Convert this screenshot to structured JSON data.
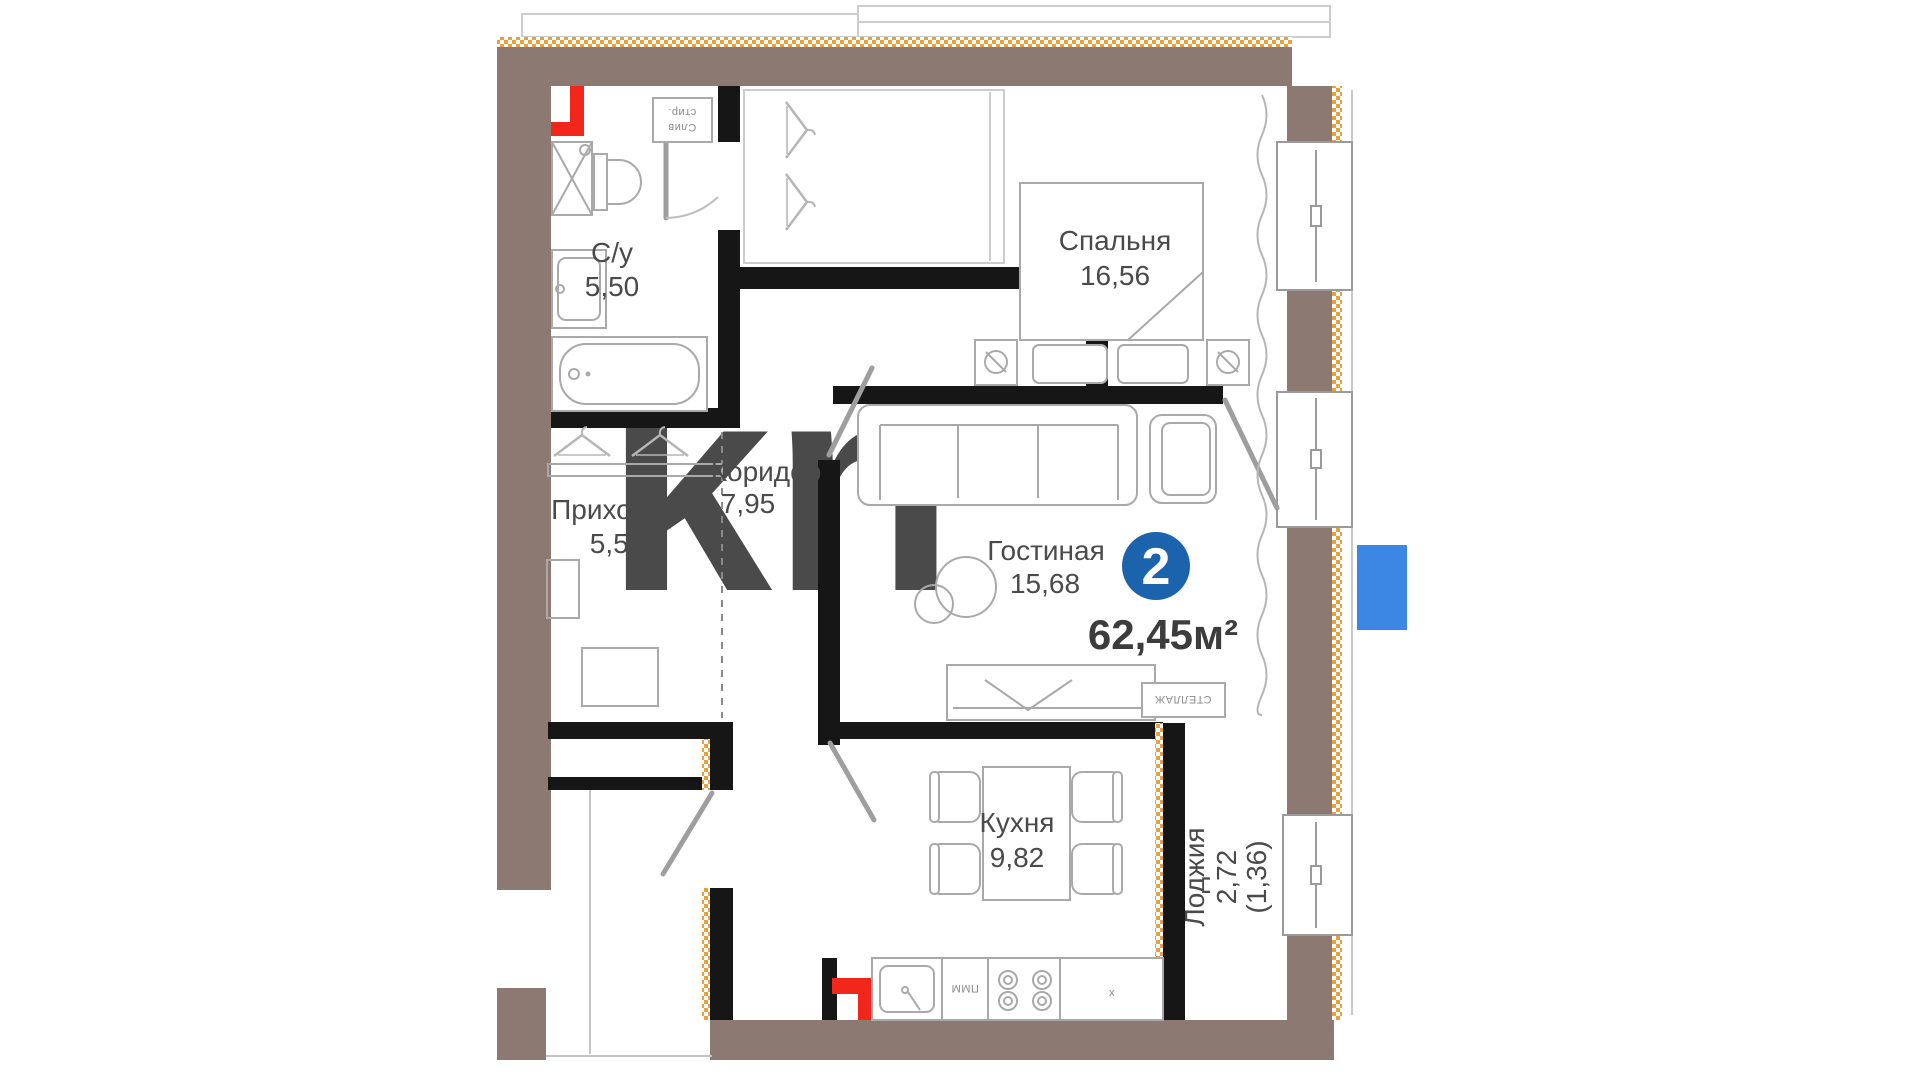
{
  "plan": {
    "badge_rooms": "2",
    "total_area": "62,45м²",
    "watermark": "kn"
  },
  "rooms": {
    "bathroom": {
      "name": "С/у",
      "area": "5,50"
    },
    "bedroom": {
      "name": "Спальня",
      "area": "16,56"
    },
    "corridor": {
      "name": "Коридор",
      "area": "7,95"
    },
    "hallway": {
      "name": "Прихожая",
      "area": "5,58"
    },
    "living": {
      "name": "Гостиная",
      "area": "15,68"
    },
    "kitchen": {
      "name": "Кухня",
      "area": "9,82"
    },
    "loggia": {
      "name": "Лоджия",
      "area": "2,72",
      "coef": "(1,36)"
    }
  },
  "annotations": {
    "drain_line1": "Слив",
    "drain_line2": "стир.",
    "shelf": "СТЕЛЛАЖ",
    "dishwasher": "ПММ",
    "counter_mark": "x"
  },
  "colors": {
    "wall_brown": "#8C7A72",
    "insulation_orange": "#E8A13C",
    "wall_black": "#161616",
    "badge_blue": "#1B63AC",
    "marker_blue": "#3B87E3",
    "pipe_red": "#F2261B",
    "line_gray": "#9E9E9E"
  }
}
